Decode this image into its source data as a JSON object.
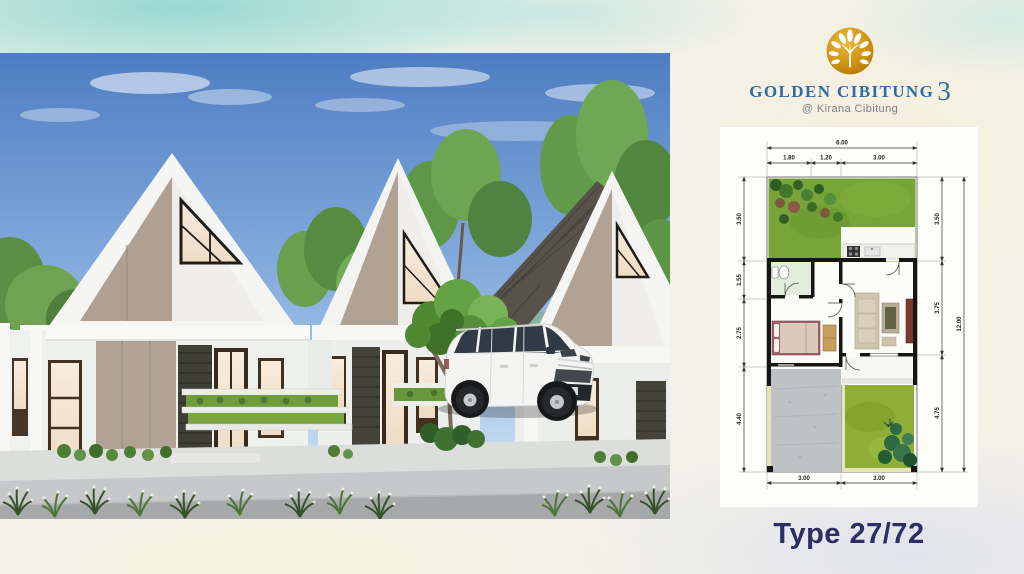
{
  "brand": {
    "title": "GOLDEN CIBITUNG",
    "title_number": "3",
    "subtitle": "@ Kirana Cibitung"
  },
  "colors": {
    "title_blue": "#2d6ba3",
    "logo_gold": "#c8860d",
    "type_navy": "#2b2f63",
    "grass_green": "#76a437",
    "wall_black": "#161616"
  },
  "type_label": "Type 27/72",
  "floorplan": {
    "dims": {
      "top_total": "6.00",
      "top_segments": [
        "1.80",
        "1.20",
        "3.00"
      ],
      "left": [
        "3.50",
        "1.55",
        "2.75",
        "4.40"
      ],
      "right": [
        "3.50",
        "3.75",
        "4.75"
      ],
      "right_total": "12.00",
      "bottom": [
        "3.00",
        "3.00"
      ]
    }
  }
}
